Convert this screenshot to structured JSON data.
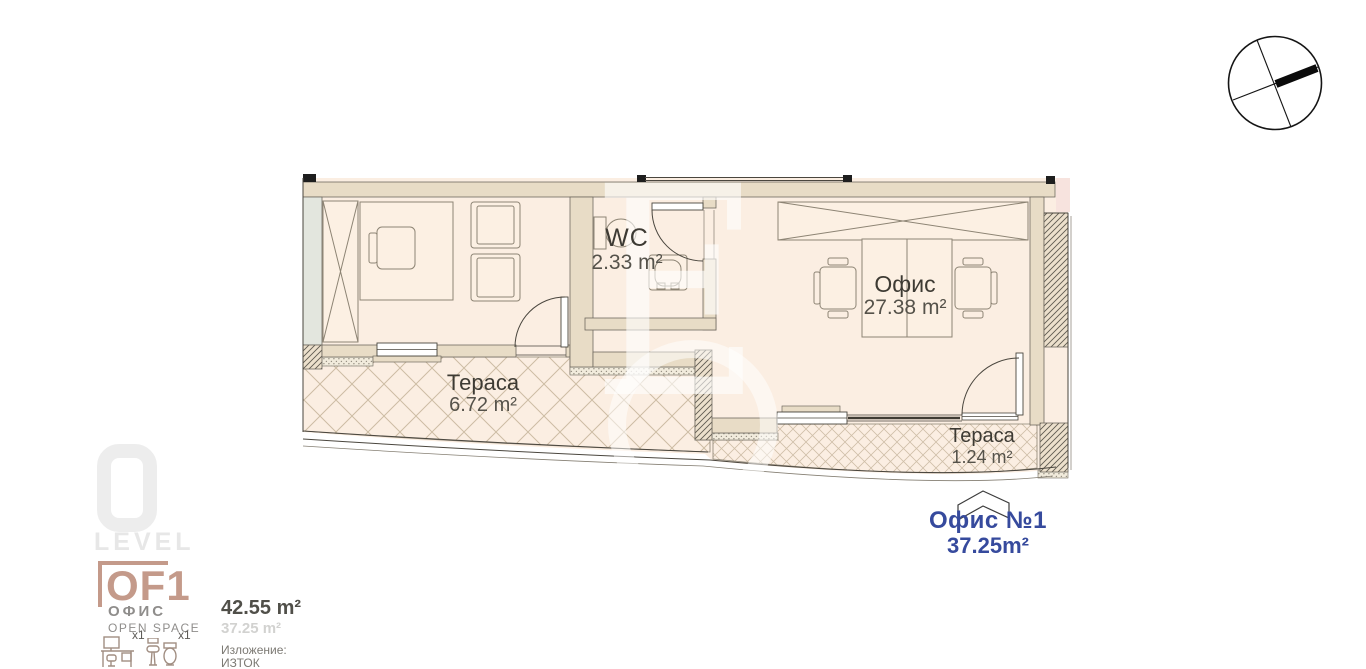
{
  "plan": {
    "rooms": [
      {
        "name": "WC",
        "area": "2.33 m²"
      },
      {
        "name": "Офис",
        "area": "27.38 m²"
      },
      {
        "name": "Тераса",
        "area": "6.72 m²"
      },
      {
        "name": "Тераса",
        "area": "1.24 m²"
      }
    ],
    "unit_label": {
      "name": "Офис №1",
      "area": "37.25m²"
    },
    "watermark_letter": "E"
  },
  "icons": {
    "compass": "compass-orientation-icon",
    "workspace": "desk-workspace-icon",
    "wc": "toilet-sink-icon"
  },
  "legend": {
    "brand": "LEVEL",
    "logo": "OF1",
    "unit_type": "ОФИС",
    "unit_subtype": "OPEN SPACE",
    "workspace_count": "x1",
    "wc_count": "x1",
    "total_area": "42.55 m²",
    "net_area": "37.25 m²",
    "exposure_label": "Изложение:",
    "exposure_value": "ИЗТОК"
  },
  "colors": {
    "accent_blue": "#364a9d",
    "logo_salmon": "#c49a8a",
    "floor": "#fbeee2",
    "wall": "#e8dcc6",
    "level_gray": "#ededed"
  }
}
